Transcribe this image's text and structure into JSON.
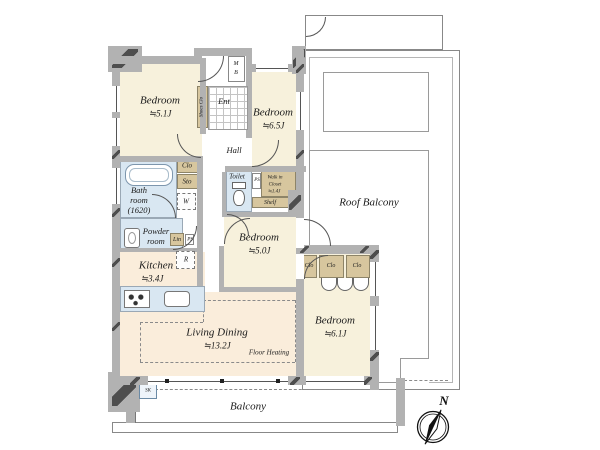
{
  "title": "Apartment floor plan",
  "colors": {
    "room-cream": "#f7f1dc",
    "room-warm": "#faeddb",
    "wet-blue": "#d9e7f2",
    "closet-tan": "#d7c69e",
    "wall-gray": "#b2b2b2"
  },
  "rooms": {
    "bedroom1": {
      "name": "Bedroom",
      "size": "≒5.1J"
    },
    "bedroom2": {
      "name": "Bedroom",
      "size": "≒6.5J"
    },
    "bedroom3": {
      "name": "Bedroom",
      "size": "≒5.0J"
    },
    "bedroom4": {
      "name": "Bedroom",
      "size": "≒6.1J"
    },
    "living_dining": {
      "name": "Living Dining",
      "size": "≒13.2J",
      "note": "Floor Heating"
    },
    "kitchen": {
      "name": "Kitchen",
      "size": "≒3.4J"
    },
    "bathroom": {
      "line1": "Bath",
      "line2": "room",
      "line3": "(1620)"
    },
    "powder_room": {
      "line1": "Powder",
      "line2": "room"
    },
    "toilet": {
      "name": "Toilet"
    },
    "walk_in_closet": {
      "line1": "Walk in",
      "line2": "Closet",
      "line3": "≒1.4J"
    },
    "hall": {
      "name": "Hall"
    },
    "entrance": {
      "name": "Ent"
    },
    "roof_balcony": {
      "name": "Roof Balcony"
    },
    "balcony": {
      "name": "Balcony"
    }
  },
  "storage": {
    "shoes_closet": "Shoes Clo",
    "closet": "Clo",
    "storage": "Sto",
    "linen": "Lin",
    "shelf": "Shelf",
    "washer": "W",
    "fridge": "R",
    "pipe_space": "PS",
    "meter_box_m": "M",
    "meter_box_b": "B",
    "bedroom4_closets": [
      "Clo",
      "Clo",
      "Clo"
    ],
    "slop_sink": "SK"
  },
  "compass": {
    "north": "N"
  }
}
